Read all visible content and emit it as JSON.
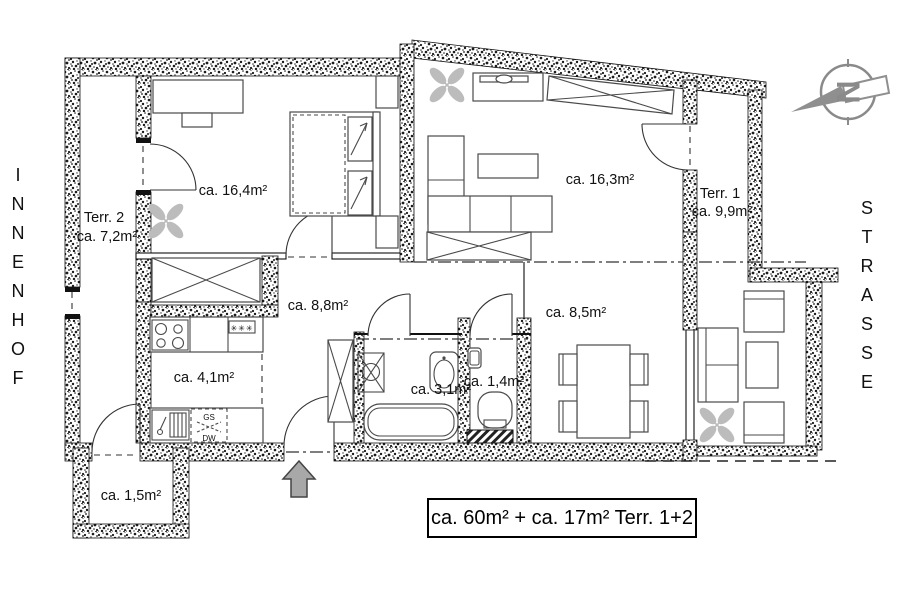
{
  "context": {
    "left_label": "INNENHOF",
    "right_label": "STRASSE"
  },
  "compass": {
    "north_letter": "N"
  },
  "rooms": {
    "terr2": {
      "name": "Terr. 2",
      "area": "ca. 7,2m²"
    },
    "bedroom": {
      "area": "ca. 16,4m²"
    },
    "living": {
      "area": "ca. 16,3m²"
    },
    "terr1": {
      "name": "Terr. 1",
      "area": "ca. 9,9m²"
    },
    "hall": {
      "area": "ca. 8,8m²"
    },
    "dining": {
      "area": "ca. 8,5m²"
    },
    "kitchen": {
      "area": "ca. 4,1m²"
    },
    "bath": {
      "area": "ca. 3,1m²"
    },
    "wc": {
      "area": "ca. 1,4m²"
    },
    "balcony": {
      "area": "ca. 1,5m²"
    }
  },
  "kitchen_symbols": {
    "dishwasher_top": "GS",
    "dishwasher_bottom": "DW",
    "freezer": "✳✳✳"
  },
  "summary": {
    "total": "ca. 60m² + ca. 17m² Terr. 1+2"
  },
  "colors": {
    "background": "#ffffff",
    "wall_dots": "#1b1b1b",
    "line": "#2d2d2d",
    "furniture": "#4a4a4a",
    "plant": "#bcbcbc",
    "arrow_fill": "#a8a8a8",
    "compass": "#8a8a8a",
    "text": "#111111"
  }
}
